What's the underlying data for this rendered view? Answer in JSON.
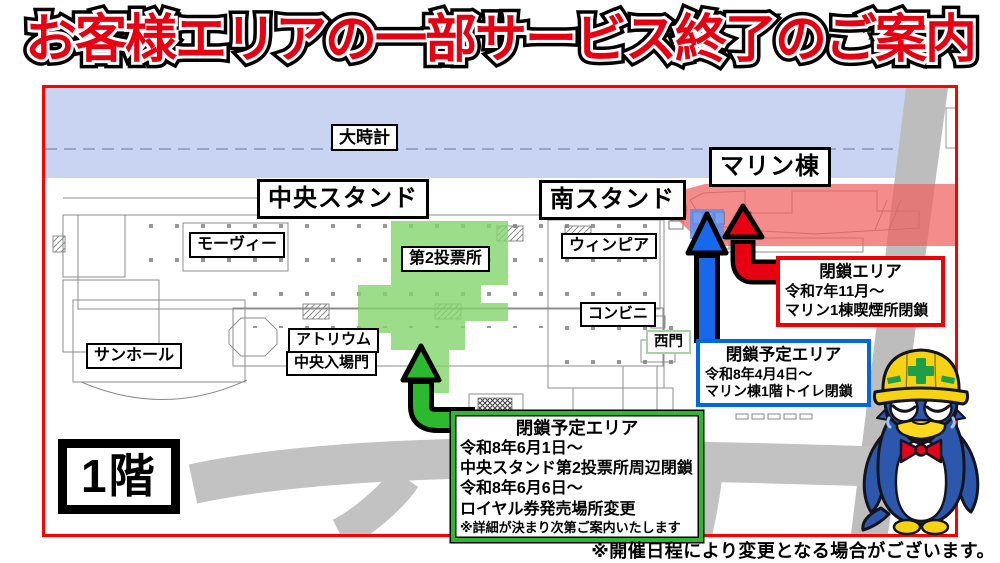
{
  "title": "お客様エリアの一部サービス終了のご案内",
  "floor_badge": "1階",
  "footer_note": "※開催日程により変更となる場合がございます。",
  "map_labels": {
    "big_clock": "大時計",
    "marine_bldg": "マリン棟",
    "central_stand": "中央スタンド",
    "south_stand": "南スタンド",
    "movie": "モーヴィー",
    "voting2": "第2投票所",
    "winpia": "ウィンピア",
    "conbini": "コンビニ",
    "atrium": "アトリウム",
    "central_gate": "中央入場門",
    "sun_hall": "サンホール",
    "west_gate": "西門"
  },
  "callouts": {
    "closed": {
      "title": "閉鎖エリア",
      "lines": [
        "令和7年11月〜",
        "マリン1棟喫煙所閉鎖"
      ]
    },
    "planned_toilet": {
      "title": "閉鎖予定エリア",
      "lines": [
        "令和8年4月4日〜",
        "マリン棟1階トイレ閉鎖"
      ]
    },
    "planned_voting": {
      "title": "閉鎖予定エリア",
      "lines": [
        "令和8年6月1日〜",
        "中央スタンド第2投票所周辺閉鎖",
        "令和8年6月6日〜",
        "ロイヤル券発売場所変更"
      ],
      "note": "※詳細が決まり次第ご案内いたします"
    }
  },
  "legend_colors": {
    "title_red": "#e60012",
    "map_border_red": "#ff0000",
    "water_blue": "#c9d3f2",
    "closed_area_red": "#f15f5f",
    "planned_area_green": "#82d46b",
    "planned_area_blue": "#5d8ff0",
    "road_gray": "#c2c2c2",
    "arrow_red": "#e60012",
    "arrow_blue": "#1768ec",
    "arrow_green": "#2db92d"
  }
}
